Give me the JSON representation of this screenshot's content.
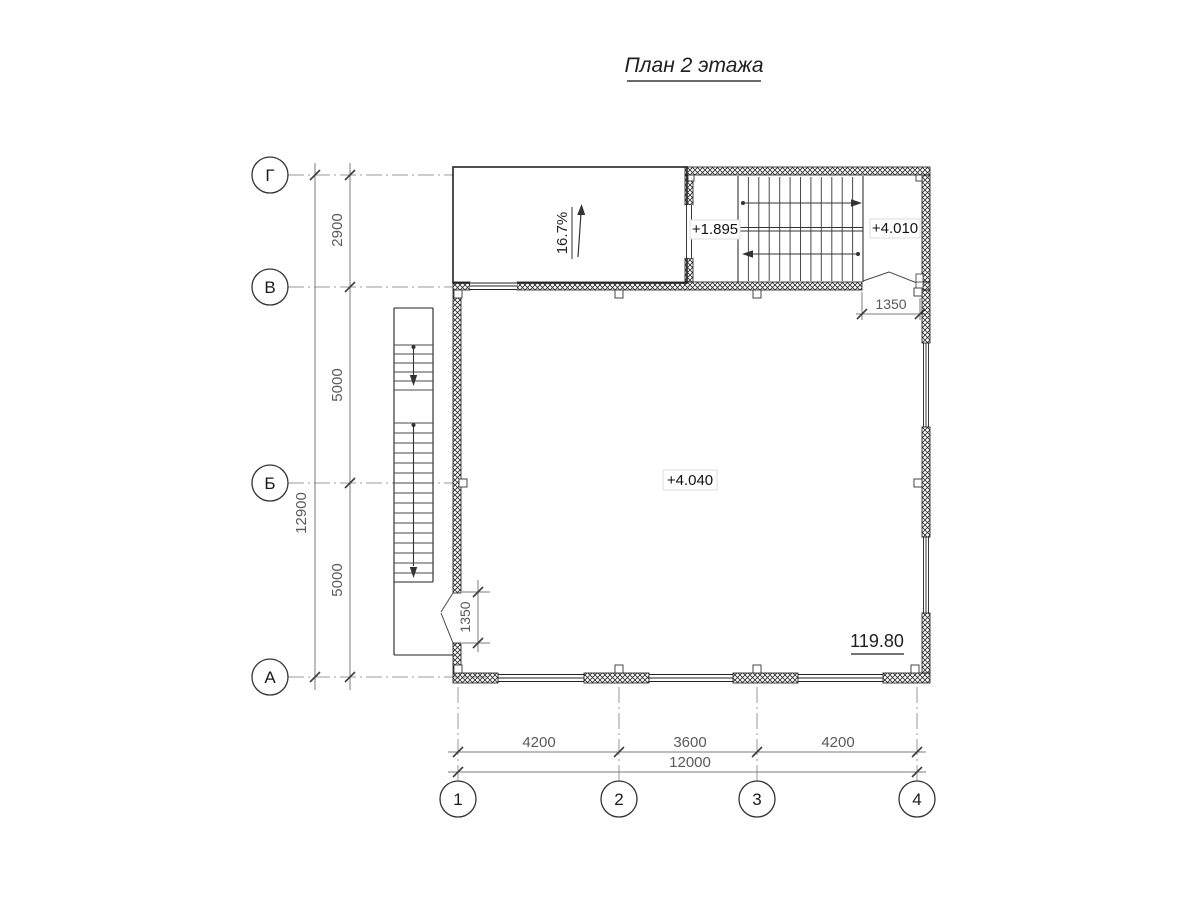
{
  "title": "План 2 этажа",
  "axes": {
    "rows": [
      "Г",
      "В",
      "Б",
      "А"
    ],
    "cols": [
      "1",
      "2",
      "3",
      "4"
    ]
  },
  "dimensions": {
    "left_segments": [
      "2900",
      "5000",
      "5000"
    ],
    "left_total": "12900",
    "bottom_segments": [
      "4200",
      "3600",
      "4200"
    ],
    "bottom_total": "12000",
    "left_door_width": "1350",
    "right_door_width": "1350"
  },
  "labels": {
    "ramp_slope": "16.7%",
    "stair_mid_landing_level": "+1.895",
    "stair_top_level": "+4.010",
    "floor_level": "+4.040",
    "room_area": "119.80"
  },
  "colors": {
    "ink": "#1f1f1f",
    "dimension_gray": "#5a5a5a",
    "hatch": "#2a2a2a"
  }
}
